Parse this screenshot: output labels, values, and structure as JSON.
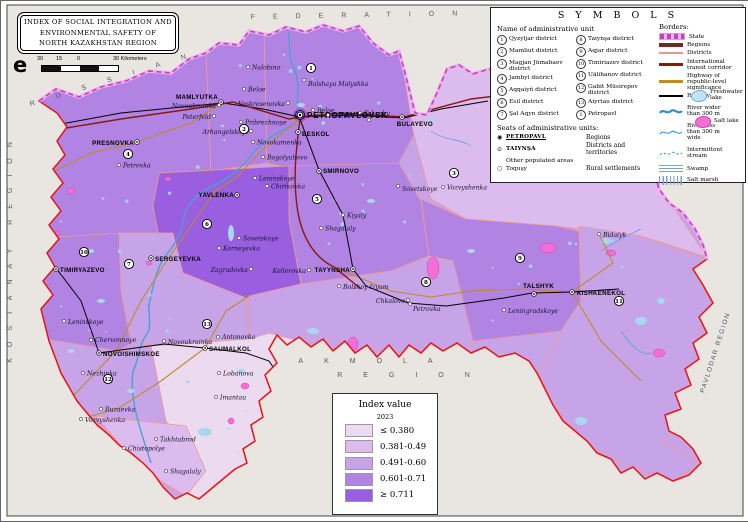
{
  "title_box": {
    "lines": [
      "INDEX OF SOCIAL INTEGRATION AND",
      "ENVIRONMENTAL SAFETY OF",
      "NORTH KAZAKHSTAN REGION"
    ]
  },
  "scale_bar": {
    "compass_glyph": "e",
    "ticks": [
      "30",
      "15",
      "0"
    ],
    "end_label": "30 Kilometers"
  },
  "symbols_panel": {
    "title": "S Y M B O L S",
    "left_heading": "Name of administrative unit",
    "districts_col1": [
      {
        "num": "1",
        "label": "Qyzyljar district"
      },
      {
        "num": "2",
        "label": "Mamliut district"
      },
      {
        "num": "3",
        "label": "Magjan Jūmabaev district"
      },
      {
        "num": "4",
        "label": "Jambyl district"
      },
      {
        "num": "5",
        "label": "Aqqaiyñ district"
      },
      {
        "num": "6",
        "label": "Esil district"
      },
      {
        "num": "7",
        "label": "Şal Aqyn district"
      }
    ],
    "districts_col2": [
      {
        "num": "8",
        "label": "Taiynşa district"
      },
      {
        "num": "9",
        "label": "Aqjar district"
      },
      {
        "num": "10",
        "label": "Timiriazev district"
      },
      {
        "num": "11",
        "label": "Uälihanov district"
      },
      {
        "num": "12",
        "label": "Gabit Müsirepov district"
      },
      {
        "num": "13",
        "label": "Aiyrtau district"
      },
      {
        "num": "I",
        "label": "Petropavl"
      }
    ],
    "seats_heading": "Seats of administrative units:",
    "seats": [
      {
        "sym": "◉",
        "name": "PETROPAVL",
        "desc": "Regions",
        "strong": true,
        "underline": true
      },
      {
        "sym": "⊙",
        "name": "TAIYNŞA",
        "desc": "Districts and territories",
        "strong": true,
        "underline": false
      },
      {
        "sym": "",
        "name": "Other populated areas",
        "desc": "",
        "strong": false,
        "underline": false
      },
      {
        "sym": "○",
        "name": "Toquşy",
        "desc": "Rural settlements",
        "strong": false,
        "underline": false
      }
    ],
    "borders_heading": "Borders:",
    "line_legend": [
      {
        "label": "State",
        "style": "state"
      },
      {
        "label": "Regions",
        "style": "regions"
      },
      {
        "label": "Districts",
        "style": "districts"
      },
      {
        "label": "International transit corridor",
        "style": "transit"
      },
      {
        "label": "Highway of republic-level significance",
        "style": "highway"
      },
      {
        "label": "Railway",
        "style": "railway"
      },
      {
        "label": "River wider than 300 m",
        "style": "river-wide",
        "narrow": true
      },
      {
        "label": "River less than 300 m wide",
        "style": "river-narrow",
        "narrow": true
      },
      {
        "label": "Intermittent stream",
        "style": "intermittent"
      },
      {
        "label": "Swamp",
        "style": "swamp"
      },
      {
        "label": "Salt marsh",
        "style": "saltmarsh"
      }
    ],
    "area_legend": [
      {
        "label": "Freshwater lake",
        "style": "freshwater"
      },
      {
        "label": "Salt lake",
        "style": "saltlake"
      }
    ]
  },
  "index_legend": {
    "title": "Index value",
    "year": "2023",
    "classes": [
      {
        "label": "≤ 0.380",
        "color": "#ecdaf0"
      },
      {
        "label": "0.381-0.49",
        "color": "#dcbcee"
      },
      {
        "label": "0.491-0.60",
        "color": "#c7a3e8"
      },
      {
        "label": "0.601-0.71",
        "color": "#b184e3"
      },
      {
        "label": "≥ 0.711",
        "color": "#9a5fe0"
      }
    ]
  },
  "map": {
    "neighbor_labels": [
      {
        "text": "RUSSIAN",
        "x": 118,
        "y": 78,
        "rotate": -17,
        "ls": 22,
        "fs": 7
      },
      {
        "text": "FEDERATION",
        "x": 362,
        "y": 16,
        "rotate": -1,
        "ls": 18,
        "fs": 7
      },
      {
        "text": "KOSTANAY REGION",
        "x": 11,
        "y": 246,
        "rotate": -90,
        "ls": 11,
        "fs": 7
      },
      {
        "text": "PAVLODAR REGION",
        "x": 716,
        "y": 352,
        "rotate": -72,
        "ls": 1.5,
        "fs": 6.5
      },
      {
        "text": "AKMOLA",
        "x": 375,
        "y": 362,
        "rotate": 0,
        "ls": 21,
        "fs": 7
      },
      {
        "text": "REGION",
        "x": 413,
        "y": 376,
        "rotate": 0,
        "ls": 21,
        "fs": 7
      }
    ],
    "district_numbers": [
      {
        "n": "1",
        "x": 310,
        "y": 67
      },
      {
        "n": "2",
        "x": 243,
        "y": 128
      },
      {
        "n": "3",
        "x": 453,
        "y": 172
      },
      {
        "n": "4",
        "x": 127,
        "y": 153
      },
      {
        "n": "5",
        "x": 316,
        "y": 198
      },
      {
        "n": "6",
        "x": 206,
        "y": 223
      },
      {
        "n": "7",
        "x": 128,
        "y": 263
      },
      {
        "n": "8",
        "x": 425,
        "y": 281
      },
      {
        "n": "9",
        "x": 519,
        "y": 257
      },
      {
        "n": "10",
        "x": 83,
        "y": 251
      },
      {
        "n": "11",
        "x": 618,
        "y": 300
      },
      {
        "n": "12",
        "x": 107,
        "y": 378
      },
      {
        "n": "13",
        "x": 206,
        "y": 323
      }
    ],
    "settlements": [
      {
        "name": "PETROPAVLOVSK",
        "x": 299,
        "y": 114,
        "t": "c",
        "lx": 306,
        "ly": 117
      },
      {
        "name": "MAMLYUTKA",
        "x": 220,
        "y": 101,
        "t": "s",
        "an": "end",
        "lx": 217,
        "ly": 98
      },
      {
        "name": "PRESNOVKA",
        "x": 136,
        "y": 141,
        "t": "s",
        "an": "end",
        "lx": 133,
        "ly": 144
      },
      {
        "name": "BESKOL",
        "x": 297,
        "y": 131,
        "t": "s",
        "lx": 301,
        "ly": 135
      },
      {
        "name": "BULAYEVO",
        "x": 401,
        "y": 116,
        "t": "s",
        "an": "end",
        "lx": 432,
        "ly": 125
      },
      {
        "name": "SMIRNOVO",
        "x": 318,
        "y": 170,
        "t": "s",
        "lx": 322,
        "ly": 172
      },
      {
        "name": "YAVLENKA",
        "x": 236,
        "y": 194,
        "t": "s",
        "an": "end",
        "lx": 233,
        "ly": 196
      },
      {
        "name": "SERGEYEVKA",
        "x": 150,
        "y": 257,
        "t": "s",
        "lx": 154,
        "ly": 260
      },
      {
        "name": "TIMIRYAZEVO",
        "x": 55,
        "y": 268,
        "t": "s",
        "lx": 59,
        "ly": 271
      },
      {
        "name": "NOVOISHIMSKOE",
        "x": 98,
        "y": 352,
        "t": "s",
        "lx": 102,
        "ly": 355
      },
      {
        "name": "SAUMALKOL",
        "x": 204,
        "y": 347,
        "t": "s",
        "lx": 208,
        "ly": 350
      },
      {
        "name": "TAYYNSHA",
        "x": 352,
        "y": 268,
        "t": "s",
        "an": "end",
        "lx": 349,
        "ly": 271
      },
      {
        "name": "TALSHYK",
        "x": 533,
        "y": 293,
        "t": "s",
        "an": "end",
        "lx": 553,
        "ly": 287
      },
      {
        "name": "KISHKENEKOL",
        "x": 571,
        "y": 291,
        "t": "s",
        "lx": 576,
        "ly": 294
      },
      {
        "name": "Nalobino",
        "x": 247,
        "y": 66,
        "t": "v"
      },
      {
        "name": "Bolshaya Malyshka",
        "x": 303,
        "y": 79,
        "t": "v",
        "lx": 307,
        "ly": 85
      },
      {
        "name": "Beloe",
        "x": 243,
        "y": 88,
        "t": "v"
      },
      {
        "name": "Voskresenovka",
        "x": 287,
        "y": 102,
        "t": "v",
        "an": "end",
        "lx": 284,
        "ly": 105
      },
      {
        "name": "Novoukrainka",
        "x": 218,
        "y": 104,
        "t": "v",
        "an": "end",
        "lx": 215,
        "ly": 107
      },
      {
        "name": "Peterfeld",
        "x": 213,
        "y": 115,
        "t": "v",
        "an": "end",
        "lx": 210,
        "ly": 118
      },
      {
        "name": "Pribrezhnoye",
        "x": 240,
        "y": 121,
        "t": "v"
      },
      {
        "name": "Beloe",
        "x": 312,
        "y": 109,
        "t": "v"
      },
      {
        "name": "Asanov",
        "x": 327,
        "y": 114,
        "t": "v"
      },
      {
        "name": "Tokushy",
        "x": 359,
        "y": 112,
        "t": "v"
      },
      {
        "name": "Poludino",
        "x": 368,
        "y": 119,
        "t": "v",
        "an": "end",
        "lx": 366,
        "ly": 116
      },
      {
        "name": "Arhangelskoye",
        "x": 250,
        "y": 130,
        "t": "v",
        "an": "end",
        "lx": 248,
        "ly": 133
      },
      {
        "name": "Novokamenka",
        "x": 252,
        "y": 141,
        "t": "v"
      },
      {
        "name": "Bogolyubovo",
        "x": 262,
        "y": 156,
        "t": "v"
      },
      {
        "name": "Leninskoye",
        "x": 254,
        "y": 177,
        "t": "v"
      },
      {
        "name": "Chirikovka",
        "x": 266,
        "y": 185,
        "t": "v"
      },
      {
        "name": "Petrovka",
        "x": 118,
        "y": 164,
        "t": "v"
      },
      {
        "name": "Sovetskoye",
        "x": 397,
        "y": 185,
        "t": "v",
        "lx": 401,
        "ly": 190
      },
      {
        "name": "Vozvyshenka",
        "x": 442,
        "y": 186,
        "t": "v"
      },
      {
        "name": "Kiyaly",
        "x": 342,
        "y": 214,
        "t": "v"
      },
      {
        "name": "Shagalaly",
        "x": 320,
        "y": 227,
        "t": "v"
      },
      {
        "name": "Sovetskoye",
        "x": 238,
        "y": 237,
        "t": "v"
      },
      {
        "name": "Korneyevka",
        "x": 218,
        "y": 247,
        "t": "v"
      },
      {
        "name": "Zagradovka",
        "x": 250,
        "y": 268,
        "t": "v",
        "an": "end",
        "lx": 247,
        "ly": 271
      },
      {
        "name": "Kellerovka",
        "x": 308,
        "y": 269,
        "t": "v",
        "an": "end",
        "lx": 305,
        "ly": 272
      },
      {
        "name": "Bolshoy Izyum",
        "x": 338,
        "y": 285,
        "t": "v",
        "lx": 342,
        "ly": 288
      },
      {
        "name": "Chkalovo",
        "x": 407,
        "y": 299,
        "t": "v",
        "an": "end",
        "lx": 404,
        "ly": 302
      },
      {
        "name": "Petrovka",
        "x": 409,
        "y": 303,
        "t": "v",
        "lx": 412,
        "ly": 310
      },
      {
        "name": "Leningradskoye",
        "x": 503,
        "y": 309,
        "t": "v",
        "lx": 507,
        "ly": 312
      },
      {
        "name": "Bidaiyk",
        "x": 598,
        "y": 233,
        "t": "v",
        "lx": 602,
        "ly": 236
      },
      {
        "name": "Leninskoye",
        "x": 63,
        "y": 320,
        "t": "v",
        "lx": 67,
        "ly": 323
      },
      {
        "name": "Chervonnoye",
        "x": 90,
        "y": 339,
        "t": "v",
        "lx": 94,
        "ly": 341
      },
      {
        "name": "Novoukrainka",
        "x": 163,
        "y": 340,
        "t": "v",
        "lx": 167,
        "ly": 343
      },
      {
        "name": "Antonovka",
        "x": 217,
        "y": 336,
        "t": "v",
        "lx": 221,
        "ly": 338
      },
      {
        "name": "Nezhinka",
        "x": 82,
        "y": 372,
        "t": "v"
      },
      {
        "name": "Ruzaevka",
        "x": 100,
        "y": 408,
        "t": "v"
      },
      {
        "name": "Vozvyshenka",
        "x": 80,
        "y": 418,
        "t": "v",
        "lx": 84,
        "ly": 421
      },
      {
        "name": "Chistopolye",
        "x": 123,
        "y": 447,
        "t": "v"
      },
      {
        "name": "Takhtabrod",
        "x": 155,
        "y": 438,
        "t": "v"
      },
      {
        "name": "Shagalaly",
        "x": 165,
        "y": 470,
        "t": "v"
      },
      {
        "name": "Lobanova",
        "x": 218,
        "y": 372,
        "t": "v"
      },
      {
        "name": "Imantau",
        "x": 215,
        "y": 396,
        "t": "v"
      }
    ]
  }
}
